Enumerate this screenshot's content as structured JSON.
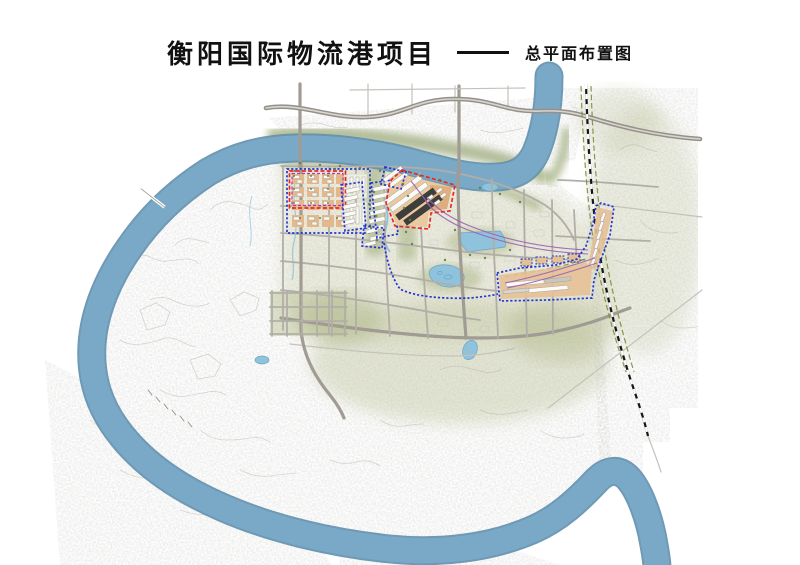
{
  "header": {
    "title": "衡阳国际物流港项目",
    "separator": "——",
    "subtitle": "总平面布置图"
  },
  "map": {
    "type": "master-plan-rendering",
    "colors": {
      "river": "#7aa9c7",
      "river_edge": "#5f8fae",
      "water_light": "#8ec2dd",
      "vegetation": "#9aa973",
      "ground_wash": "#e9ebd9",
      "road": "#b2aea7",
      "road_main": "#a09b93",
      "highway": "#94908a",
      "railway": "#161616",
      "railway_tie": "#ffffff",
      "rail_green_dash": "#7d8c3c",
      "zone_ground_orange": "#e5b88c",
      "warehouse_dark": "#3e3e3c",
      "building_white": "#fbfaf7",
      "outline_red": "#e82a1f",
      "outline_blue": "#2336cf",
      "outline_purple": "#b03ab2",
      "siding_purple": "#9a62b0",
      "title_color": "#111111"
    },
    "features": [
      {
        "name": "xiang-river",
        "kind": "water",
        "color": "#7aa9c7"
      },
      {
        "name": "riverside-greenbelt",
        "kind": "vegetation",
        "color": "#9aa973"
      },
      {
        "name": "north-expressway",
        "kind": "highway",
        "color": "#94908a"
      },
      {
        "name": "railway-line",
        "kind": "railway",
        "color": "#161616"
      },
      {
        "name": "west-industrial-zone",
        "kind": "planned-zone",
        "outline": "#e82a1f"
      },
      {
        "name": "central-warehouse-cluster",
        "kind": "planned-zone",
        "outline": "#2336cf"
      },
      {
        "name": "railway-logistics-park",
        "kind": "planned-zone",
        "outline": "#e82a1f"
      },
      {
        "name": "east-rail-corridor-zone",
        "kind": "planned-zone",
        "outline": "#2336cf"
      },
      {
        "name": "south-logistics-strip",
        "kind": "planned-zone",
        "outline": "#2336cf"
      },
      {
        "name": "rail-sidings",
        "kind": "rail-siding",
        "color": "#9a62b0"
      },
      {
        "name": "lakes-and-ponds",
        "kind": "water",
        "color": "#8ec2dd"
      },
      {
        "name": "planned-road-grid",
        "kind": "road",
        "color": "#b2aea7"
      }
    ]
  }
}
